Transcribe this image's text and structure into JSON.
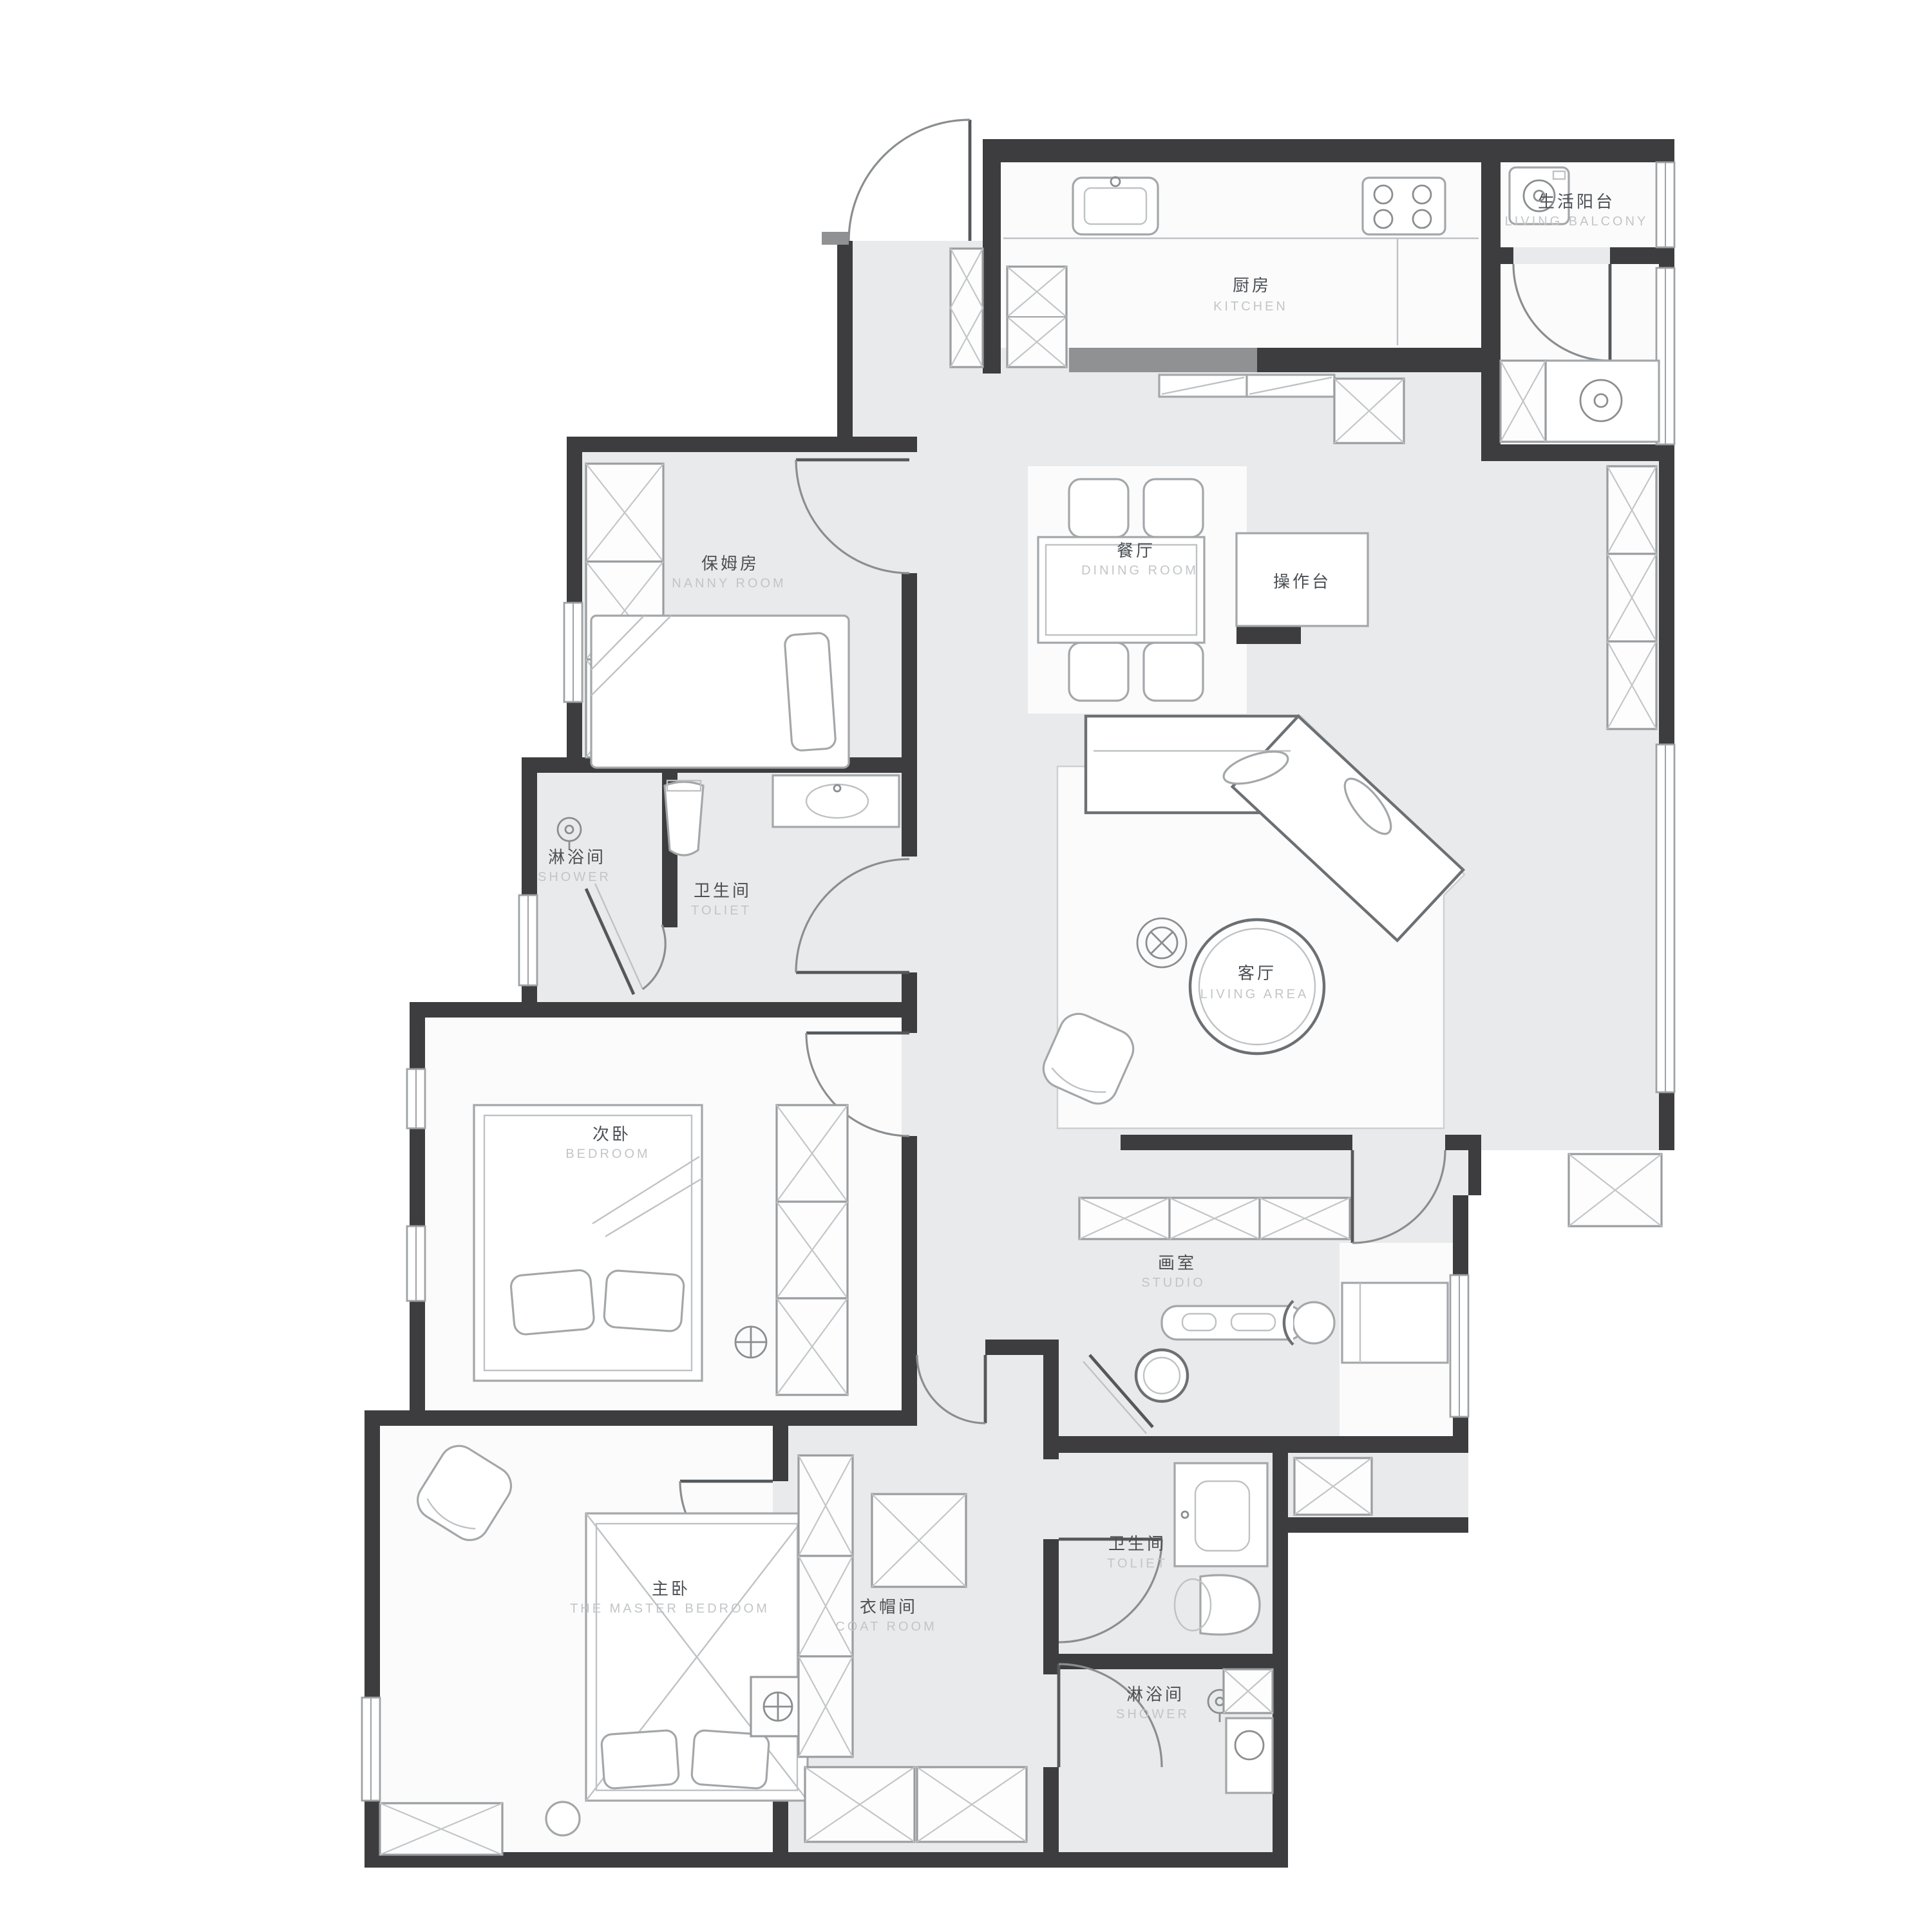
{
  "document": {
    "type": "apartment-floor-plan"
  },
  "colors": {
    "wall_dark": "#3d3d3f",
    "wall_medium": "#8f9193",
    "floor_gray": "#e9eaeb",
    "room_white": "#fbfbfc",
    "furniture_outline": "#a4a7a9",
    "label_zh": "#4b5054",
    "label_en": "#c2c5c7"
  },
  "rooms": {
    "kitchen": {
      "zh": "厨房",
      "en": "KITCHEN"
    },
    "living_balcony": {
      "zh": "生活阳台",
      "en": "LIVING BALCONY"
    },
    "dining_room": {
      "zh": "餐厅",
      "en": "DINING ROOM"
    },
    "counter": {
      "zh": "操作台"
    },
    "living_area": {
      "zh": "客厅",
      "en": "LIVING AREA"
    },
    "nanny_room": {
      "zh": "保姆房",
      "en": "NANNY ROOM"
    },
    "shower_left": {
      "zh": "淋浴间",
      "en": "SHOWER"
    },
    "toilet_left": {
      "zh": "卫生间",
      "en": "TOLIET"
    },
    "bedroom": {
      "zh": "次卧",
      "en": "BEDROOM"
    },
    "studio": {
      "zh": "画室",
      "en": "STUDIO"
    },
    "master_bedroom": {
      "zh": "主卧",
      "en": "THE MASTER BEDROOM"
    },
    "coat_room": {
      "zh": "衣帽间",
      "en": "COAT ROOM"
    },
    "toilet_right": {
      "zh": "卫生间",
      "en": "TOLIET"
    },
    "shower_right": {
      "zh": "淋浴间",
      "en": "SHOWER"
    }
  }
}
